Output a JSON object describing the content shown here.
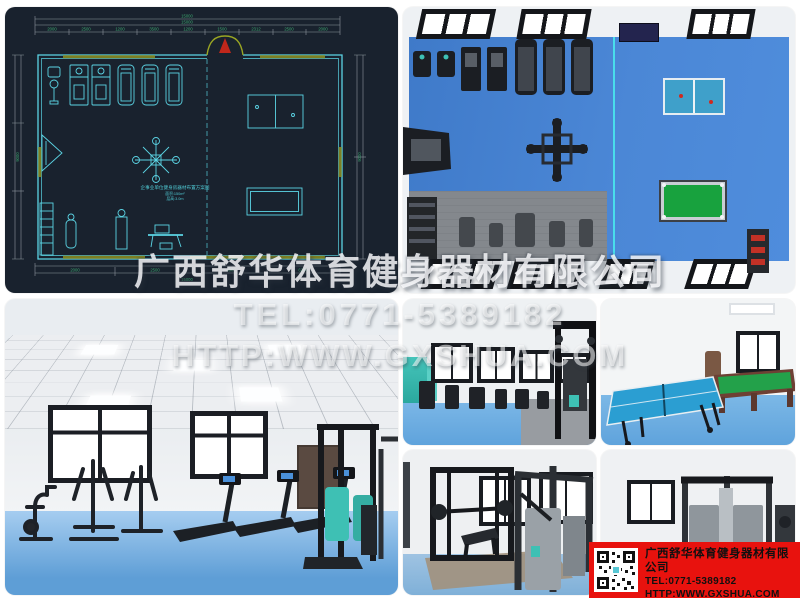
{
  "watermark": {
    "line1": "广西舒华体育健身器材有限公司",
    "line2": "TEL:0771-5389182",
    "line3": "HTTP:WWW.GXSHUA.COM"
  },
  "info_box": {
    "company": "广西舒华体育健身器材有限公司",
    "tel": "TEL:0771-5389182",
    "url": "HTTP:WWW.GXSHUA.COM",
    "qr_icon": "qr-code",
    "bg_color": "#e8120e"
  },
  "floor_plan": {
    "title_block": {
      "line1": "企事业单位健身房器材布置方案图",
      "line2": "面积:150m²",
      "line3": "层高:3.0m"
    },
    "dims": {
      "top_total_outer": "15000",
      "top_total_inner": "15000",
      "top_segments": [
        "2000",
        "2500",
        "1200",
        "3500",
        "1200",
        "1500",
        "2312",
        "2500",
        "2000"
      ],
      "bottom_segments": [
        "2000",
        "2500",
        "4300",
        "6200"
      ],
      "bottom_total": "15000",
      "left_total": "9000",
      "right_total": "9000"
    },
    "colors": {
      "background": "#19222e",
      "line": "#5bd4e4",
      "dimension": "#8e979e",
      "dimension_text": "#3da56f",
      "wall_accent": "#7c7f22",
      "door": "#c0271b"
    }
  },
  "palette": {
    "floor_blue": "#4580ce",
    "floor_light_blue": "#8cc0ea",
    "mat_gray": "#85898e",
    "pingpong_blue": "#3f9fc9",
    "billiard_green": "#18a23e",
    "teal_accent": "#3ec0b4",
    "info_red": "#e8120e"
  }
}
